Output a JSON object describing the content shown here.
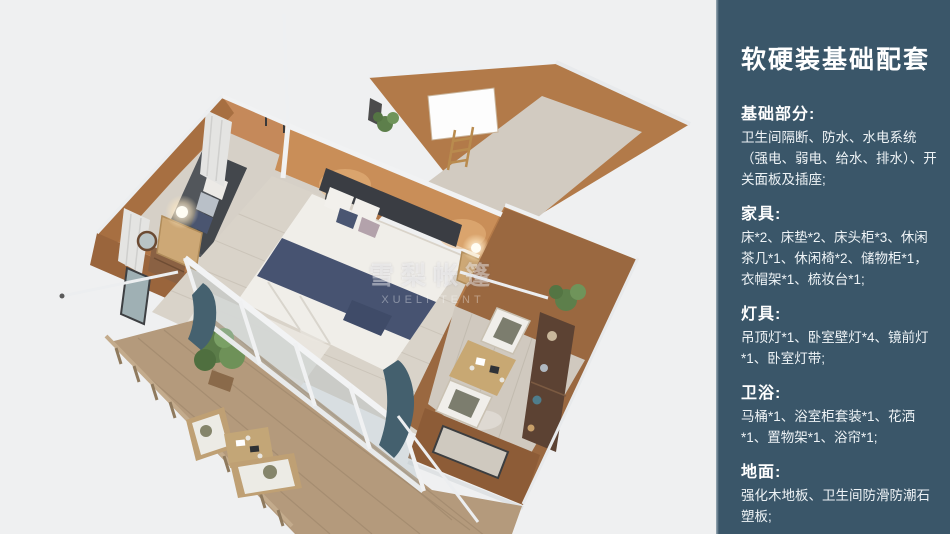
{
  "panel": {
    "title": "软硬装基础配套",
    "colors": {
      "panel_bg": "#3a5669",
      "panel_text": "#ffffff"
    },
    "sections": [
      {
        "heading": "基础部分:",
        "body": "卫生间隔断、防水、水电系统（强电、弱电、给水、排水）、开关面板及插座;"
      },
      {
        "heading": "家具:",
        "body": "床*2、床垫*2、床头柜*3、休闲茶几*1、休闲椅*2、储物柜*1，衣帽架*1、梳妆台*1;"
      },
      {
        "heading": "灯具:",
        "body": "吊顶灯*1、卧室壁灯*4、镜前灯*1、卧室灯带;"
      },
      {
        "heading": "卫浴:",
        "body": "马桶*1、浴室柜套装*1、花洒*1、置物架*1、浴帘*1;"
      },
      {
        "heading": "地面:",
        "body": "强化木地板、卫生间防滑防潮石塑板;"
      }
    ]
  },
  "illustration": {
    "watermark_cn": "雪梨帐篷",
    "watermark_en": "XUELI TENT",
    "colors": {
      "background": "#eff0f1",
      "wall_tan": "#bd8150",
      "wall_brown": "#97663e",
      "floor_wood": "#d7d1c8",
      "deck_wood": "#b49a7c",
      "frame_white": "#f2f3f4",
      "bed_navy": "#475371",
      "curtain_teal": "#45616f"
    }
  }
}
